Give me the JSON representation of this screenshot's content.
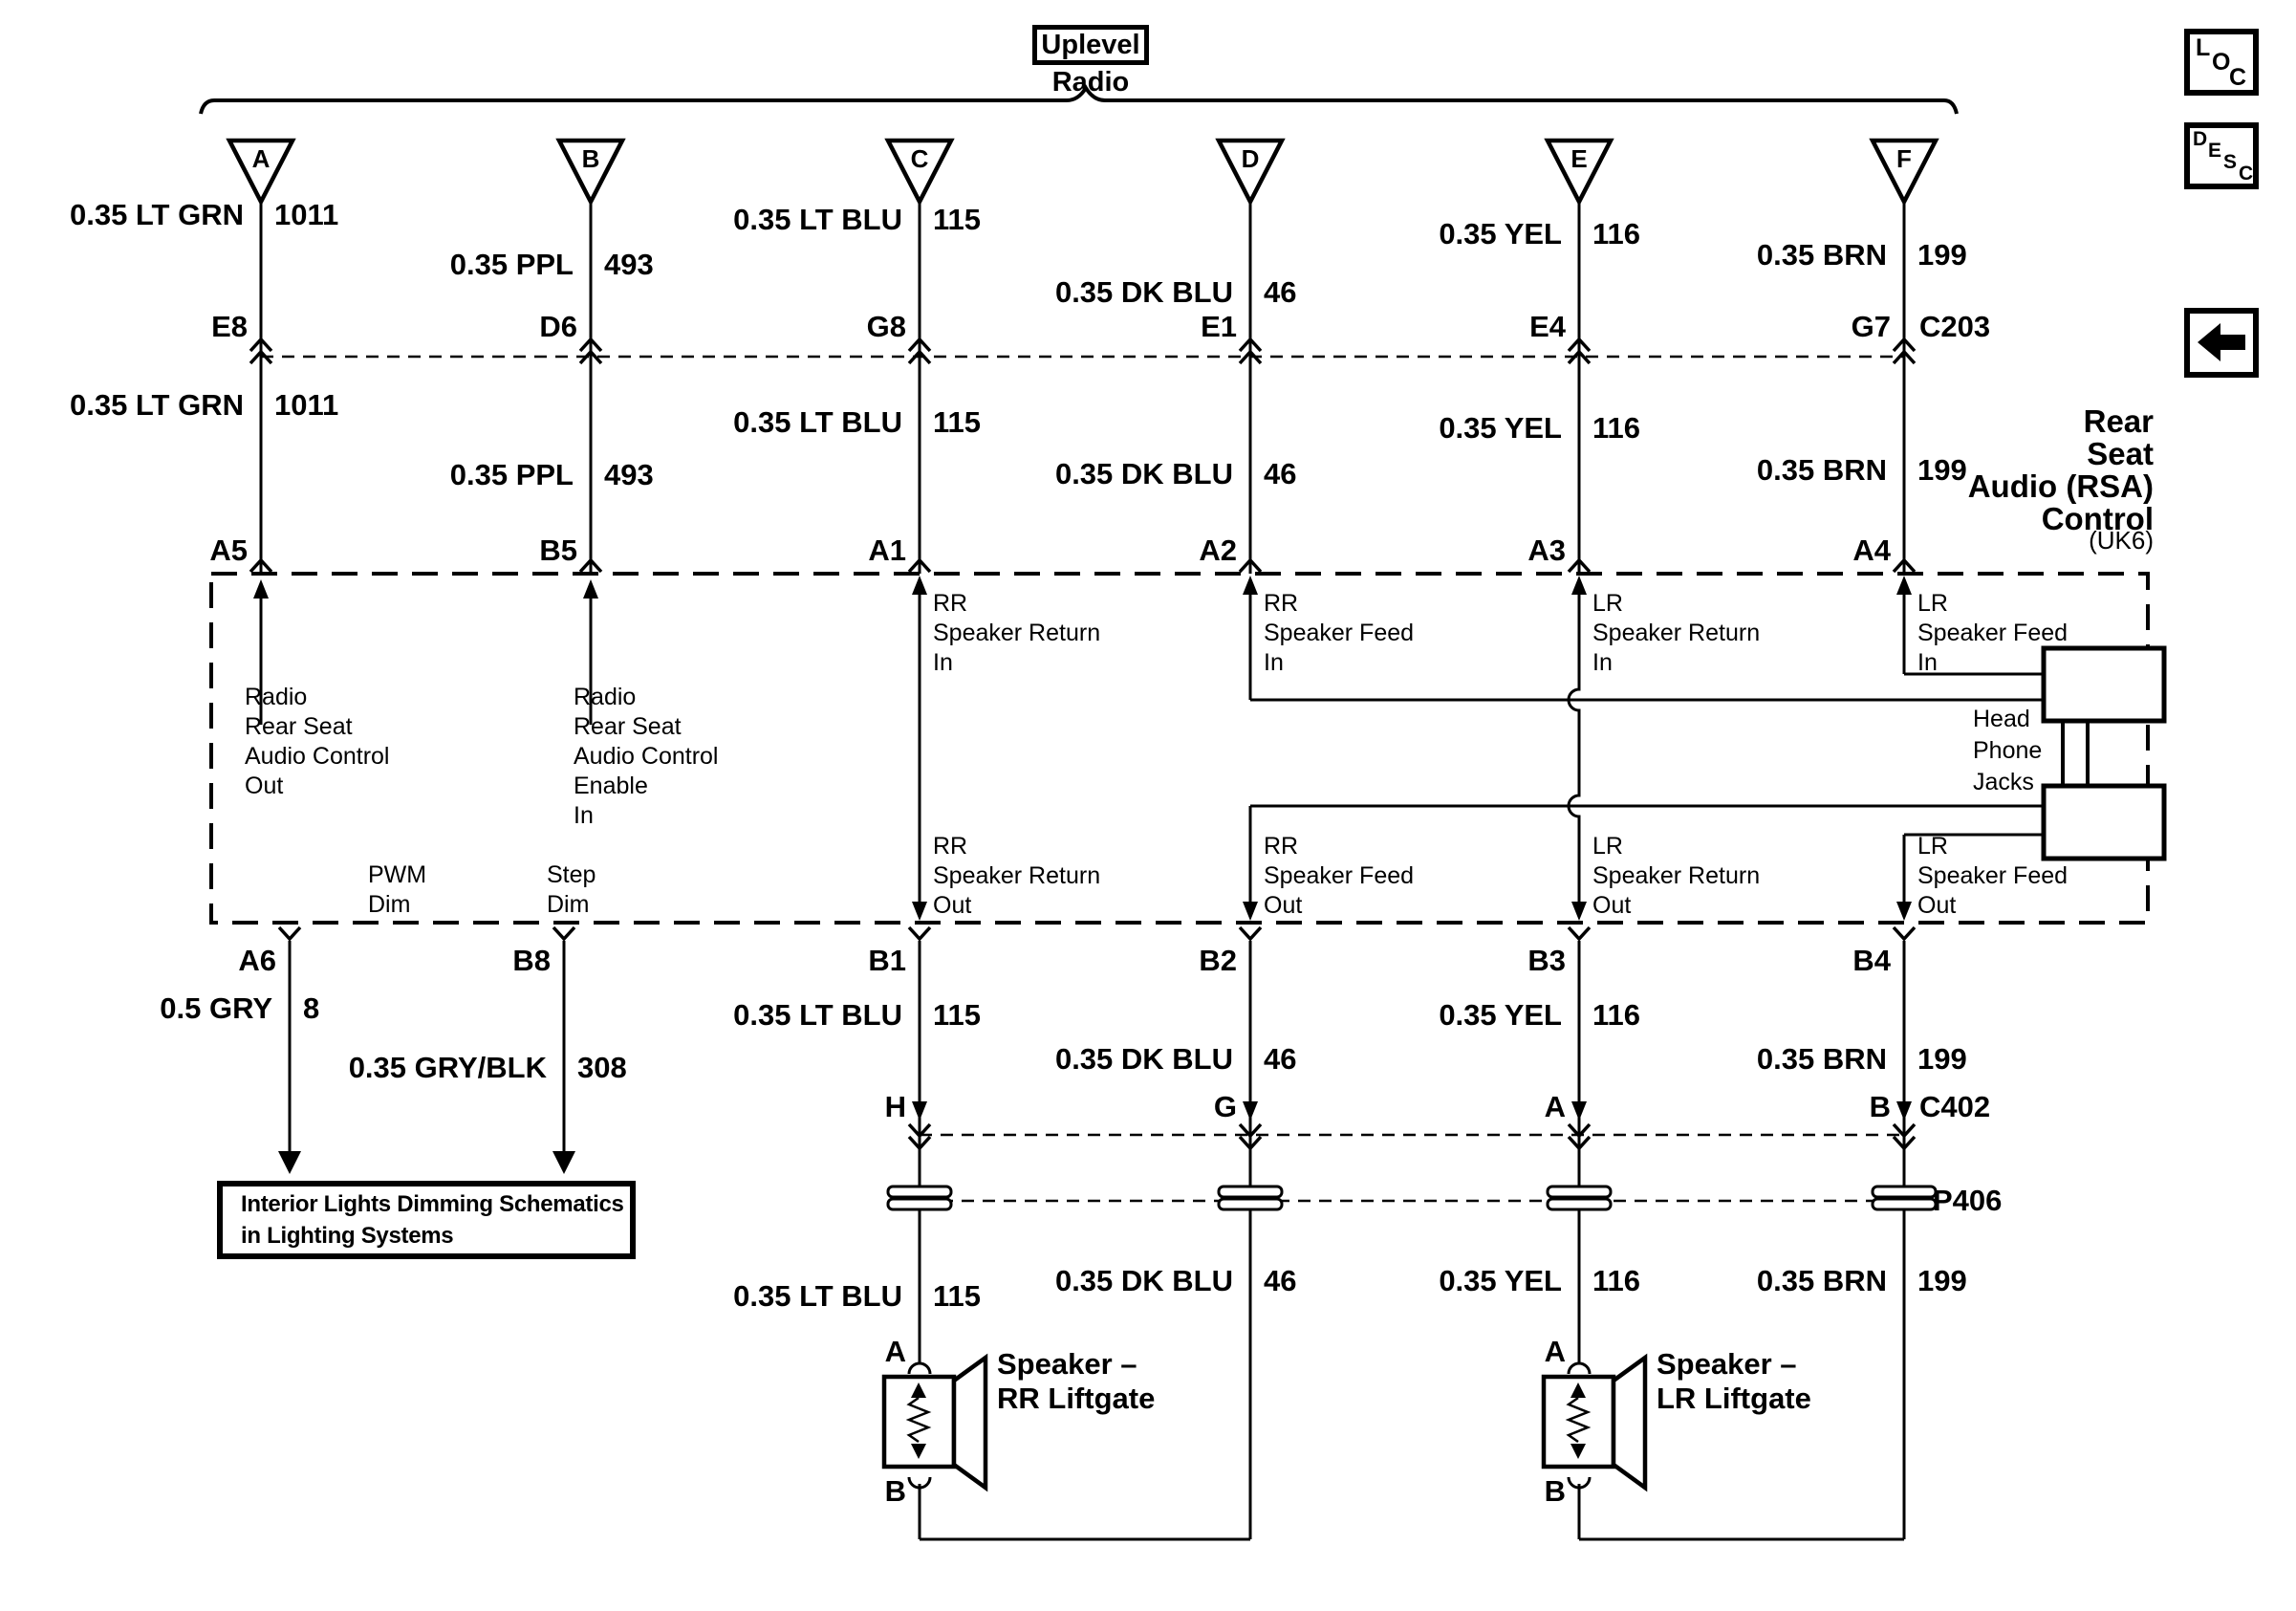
{
  "header": {
    "uplevel": "Uplevel",
    "radio": "Radio"
  },
  "corner": {
    "loc": [
      "L",
      "O",
      "C"
    ],
    "desc": [
      "D",
      "E",
      "S",
      "C"
    ]
  },
  "rsa": {
    "title": [
      "Rear",
      "Seat",
      "Audio (RSA)",
      "Control"
    ],
    "option": "(UK6)",
    "connector_c203": "C203"
  },
  "columns": [
    {
      "id": "A",
      "wire": "0.35 LT GRN",
      "circuit": "1011",
      "pin_c203": "E8",
      "pin_rsa": "A5"
    },
    {
      "id": "B",
      "wire": "0.35 PPL",
      "circuit": "493",
      "pin_c203": "D6",
      "pin_rsa": "B5"
    },
    {
      "id": "C",
      "wire": "0.35 LT BLU",
      "circuit": "115",
      "pin_c203": "G8",
      "pin_rsa": "A1"
    },
    {
      "id": "D",
      "wire": "0.35 DK BLU",
      "circuit": "46",
      "pin_c203": "E1",
      "pin_rsa": "A2"
    },
    {
      "id": "E",
      "wire": "0.35 YEL",
      "circuit": "116",
      "pin_c203": "E4",
      "pin_rsa": "A3"
    },
    {
      "id": "F",
      "wire": "0.35 BRN",
      "circuit": "199",
      "pin_c203": "G7",
      "pin_rsa": "A4"
    }
  ],
  "box_labels": {
    "a5": [
      "Radio",
      "Rear Seat",
      "Audio Control",
      "Out"
    ],
    "b5": [
      "Radio",
      "Rear Seat",
      "Audio Control",
      "Enable",
      "In"
    ],
    "a1_in": [
      "RR",
      "Speaker Return",
      "In"
    ],
    "a2_in": [
      "RR",
      "Speaker Feed",
      "In"
    ],
    "a3_in": [
      "LR",
      "Speaker Return",
      "In"
    ],
    "a4_in": [
      "LR",
      "Speaker Feed",
      "In"
    ],
    "b1_out": [
      "RR",
      "Speaker Return",
      "Out"
    ],
    "b2_out": [
      "RR",
      "Speaker Feed",
      "Out"
    ],
    "b3_out": [
      "LR",
      "Speaker Return",
      "Out"
    ],
    "b4_out": [
      "LR",
      "Speaker Feed",
      "Out"
    ],
    "pwm": [
      "PWM",
      "Dim"
    ],
    "step": [
      "Step",
      "Dim"
    ],
    "headphone": [
      "Head",
      "Phone",
      "Jacks"
    ]
  },
  "bottom": {
    "pins": [
      "A6",
      "B8",
      "B1",
      "B2",
      "B3",
      "B4"
    ],
    "wires_upper": [
      {
        "wire": "0.5 GRY",
        "circuit": "8"
      },
      {
        "wire": "0.35 GRY/BLK",
        "circuit": "308"
      },
      {
        "wire": "0.35 LT BLU",
        "circuit": "115"
      },
      {
        "wire": "0.35 DK BLU",
        "circuit": "46"
      },
      {
        "wire": "0.35 YEL",
        "circuit": "116"
      },
      {
        "wire": "0.35 BRN",
        "circuit": "199"
      }
    ],
    "c402_pins": [
      "H",
      "G",
      "A",
      "B"
    ],
    "connector_c402": "C402",
    "pass_through": "P406",
    "wires_lower": [
      {
        "wire": "0.35 LT BLU",
        "circuit": "115"
      },
      {
        "wire": "0.35 DK BLU",
        "circuit": "46"
      },
      {
        "wire": "0.35 YEL",
        "circuit": "116"
      },
      {
        "wire": "0.35 BRN",
        "circuit": "199"
      }
    ],
    "interior_ref": [
      "Interior Lights Dimming Schematics",
      "in Lighting Systems"
    ],
    "speakers": [
      {
        "pin_top": "A",
        "pin_bottom": "B",
        "label": [
          "Speaker –",
          "RR Liftgate"
        ]
      },
      {
        "pin_top": "A",
        "pin_bottom": "B",
        "label": [
          "Speaker –",
          "LR Liftgate"
        ]
      }
    ]
  }
}
